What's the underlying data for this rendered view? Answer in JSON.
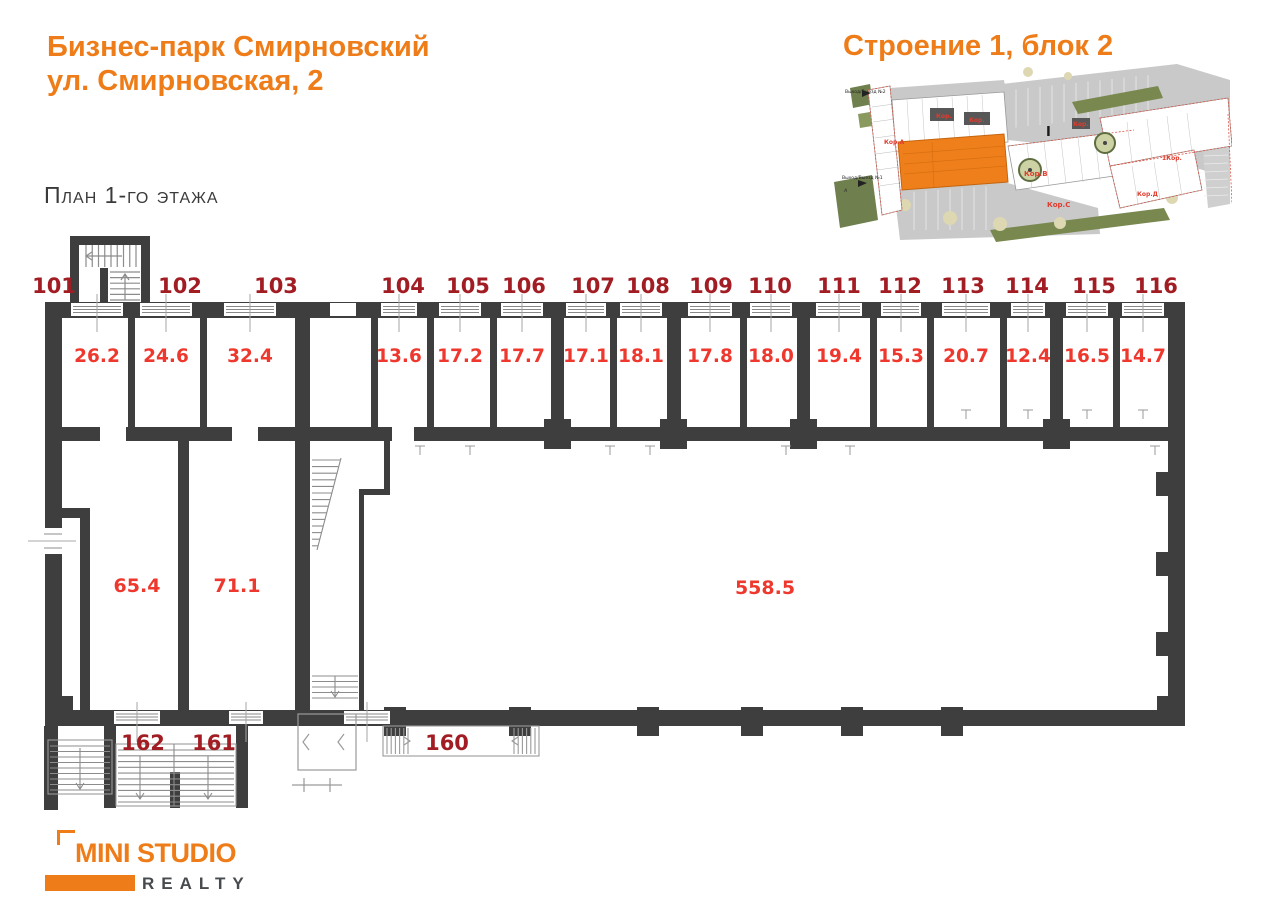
{
  "header": {
    "title_line1": "Бизнес-парк Смирновский",
    "title_line2": "ул. Смирновская, 2",
    "subtitle": "План 1-го этажа",
    "building_label": "Строение 1, блок 2"
  },
  "minimap": {
    "highlight_color": "#ef7f1b",
    "labels": {
      "kor_a": "Кор.А",
      "kor_v": "Кор.В",
      "kor_s": "Кор.С",
      "kor_d": "Кор.Д",
      "kor_1": "1Кор.",
      "kor_small_1": "Кор.",
      "kor_small_2": "Кор.",
      "kor_small_3": "Кор.",
      "exit_2": "Выход/Выезд №2",
      "exit_1": "Выход/Выезд №1",
      "marker_a": "А",
      "road_mark": "I"
    }
  },
  "plan": {
    "colors": {
      "wall": "#3e3e3e",
      "room_number": "#a21d23",
      "area_value": "#ee382e"
    },
    "rooms": [
      {
        "number": "101",
        "area": "26.2"
      },
      {
        "number": "102",
        "area": "24.6"
      },
      {
        "number": "103",
        "area": "32.4"
      },
      {
        "number": "104",
        "area": "13.6"
      },
      {
        "number": "105",
        "area": "17.2"
      },
      {
        "number": "106",
        "area": "17.7"
      },
      {
        "number": "107",
        "area": "17.1"
      },
      {
        "number": "108",
        "area": "18.1"
      },
      {
        "number": "109",
        "area": "17.8"
      },
      {
        "number": "110",
        "area": "18.0"
      },
      {
        "number": "111",
        "area": "19.4"
      },
      {
        "number": "112",
        "area": "15.3"
      },
      {
        "number": "113",
        "area": "20.7"
      },
      {
        "number": "114",
        "area": "12.4"
      },
      {
        "number": "115",
        "area": "16.5"
      },
      {
        "number": "116",
        "area": "14.7"
      }
    ],
    "halls": {
      "left_area": "65.4",
      "middle_area": "71.1",
      "main_area": "558.5"
    },
    "entrances": {
      "e162": "162",
      "e161": "161",
      "e160": "160"
    }
  },
  "logo": {
    "line1": "MINI STUDIO",
    "line2": "REALTY"
  }
}
